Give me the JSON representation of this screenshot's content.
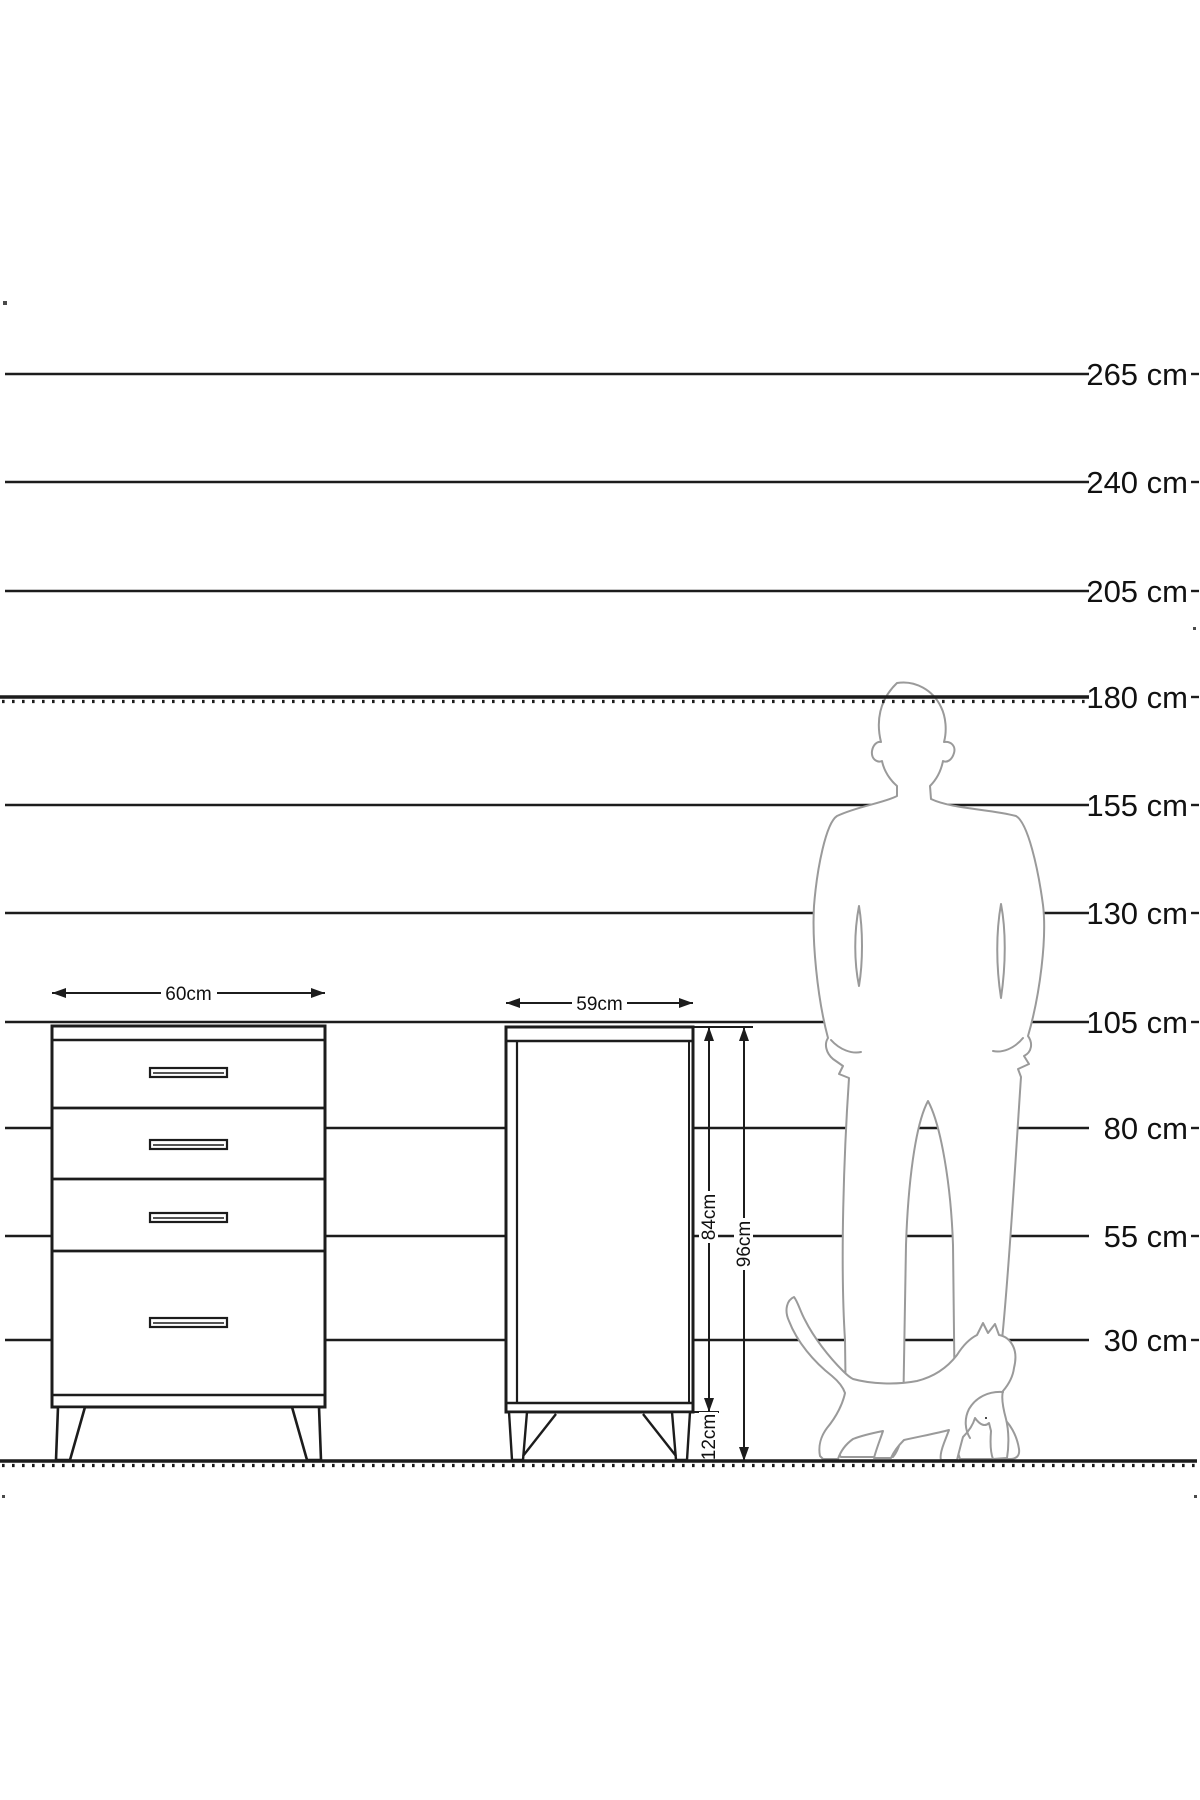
{
  "page": {
    "background": "#ffffff"
  },
  "scale": {
    "unit": "cm",
    "labels": [
      {
        "label": "265 cm",
        "cm": 265,
        "y": 374,
        "hatched": false
      },
      {
        "label": "240 cm",
        "cm": 240,
        "y": 482,
        "hatched": false
      },
      {
        "label": "205 cm",
        "cm": 205,
        "y": 591,
        "hatched": false
      },
      {
        "label": "180 cm",
        "cm": 180,
        "y": 697,
        "hatched": true
      },
      {
        "label": "155 cm",
        "cm": 155,
        "y": 805,
        "hatched": false
      },
      {
        "label": "130 cm",
        "cm": 130,
        "y": 913,
        "hatched": false
      },
      {
        "label": "105 cm",
        "cm": 105,
        "y": 1022,
        "hatched": false
      },
      {
        "label": "80 cm",
        "cm": 80,
        "y": 1128,
        "hatched": false
      },
      {
        "label": "55 cm",
        "cm": 55,
        "y": 1236,
        "hatched": false
      },
      {
        "label": "30 cm",
        "cm": 30,
        "y": 1340,
        "hatched": false
      }
    ],
    "ground_y": 1461
  },
  "furniture": {
    "dresser_front": {
      "name": "chest-of-drawers-front-view",
      "width_label": "60cm",
      "drawer_count": 4
    },
    "cabinet_side": {
      "name": "chest-of-drawers-side-view",
      "width_label": "59cm",
      "body_height_label": "84cm",
      "total_height_label": "96cm",
      "leg_height_label": "12cm"
    }
  },
  "figures": {
    "person": "standing-man-silhouette",
    "cat": "walking-cat-silhouette"
  },
  "colors": {
    "line": "#1c1c1c",
    "silhouette_stroke": "#9a9a9a",
    "background": "#ffffff"
  }
}
